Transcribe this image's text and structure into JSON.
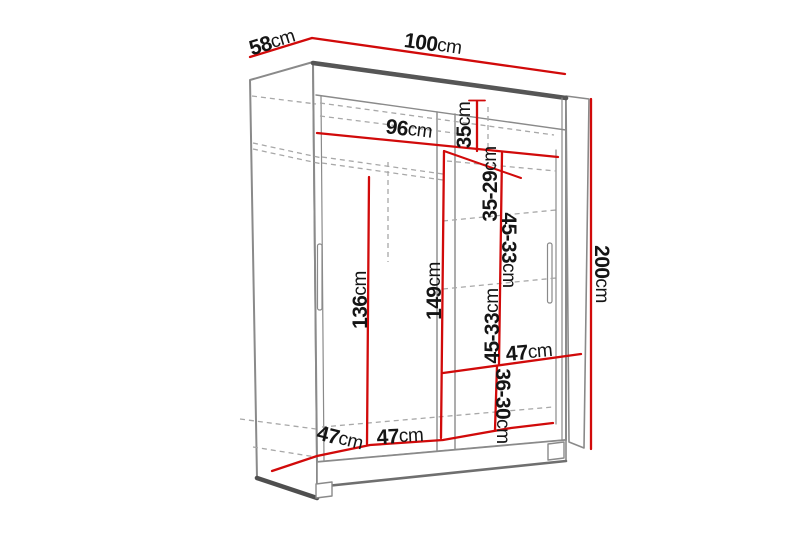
{
  "page": {
    "background": "#ffffff",
    "description": "Sliding-door wardrobe dimension diagram"
  },
  "diagram": {
    "colors": {
      "dimension_line": "#d10a0a",
      "structure_line": "#8a8a8a",
      "edge_dark": "#4f4f4f",
      "dashed_line": "#a8a8a8",
      "label_text": "#151515",
      "background": "#ffffff"
    },
    "dimensions": [
      {
        "id": "top-depth",
        "value": "58",
        "unit": "cm"
      },
      {
        "id": "top-width",
        "value": "100",
        "unit": "cm"
      },
      {
        "id": "interior-width",
        "value": "96",
        "unit": "cm"
      },
      {
        "id": "top-shelf-height",
        "value": "35",
        "unit": "cm"
      },
      {
        "id": "upper-shelf-gap",
        "value": "35-29",
        "unit": "cm"
      },
      {
        "id": "middle-shelf-gap",
        "value": "45-33",
        "unit": "cm"
      },
      {
        "id": "lower-shelf-gap",
        "value": "45-33",
        "unit": "cm"
      },
      {
        "id": "shelf-width",
        "value": "47",
        "unit": "cm"
      },
      {
        "id": "bottom-shelf-gap",
        "value": "36-30",
        "unit": "cm"
      },
      {
        "id": "hanging-space-height",
        "value": "136",
        "unit": "cm"
      },
      {
        "id": "interior-height",
        "value": "149",
        "unit": "cm"
      },
      {
        "id": "total-height",
        "value": "200",
        "unit": "cm"
      },
      {
        "id": "interior-depth",
        "value": "47",
        "unit": "cm"
      },
      {
        "id": "left-compartment-width",
        "value": "47",
        "unit": "cm"
      }
    ]
  }
}
